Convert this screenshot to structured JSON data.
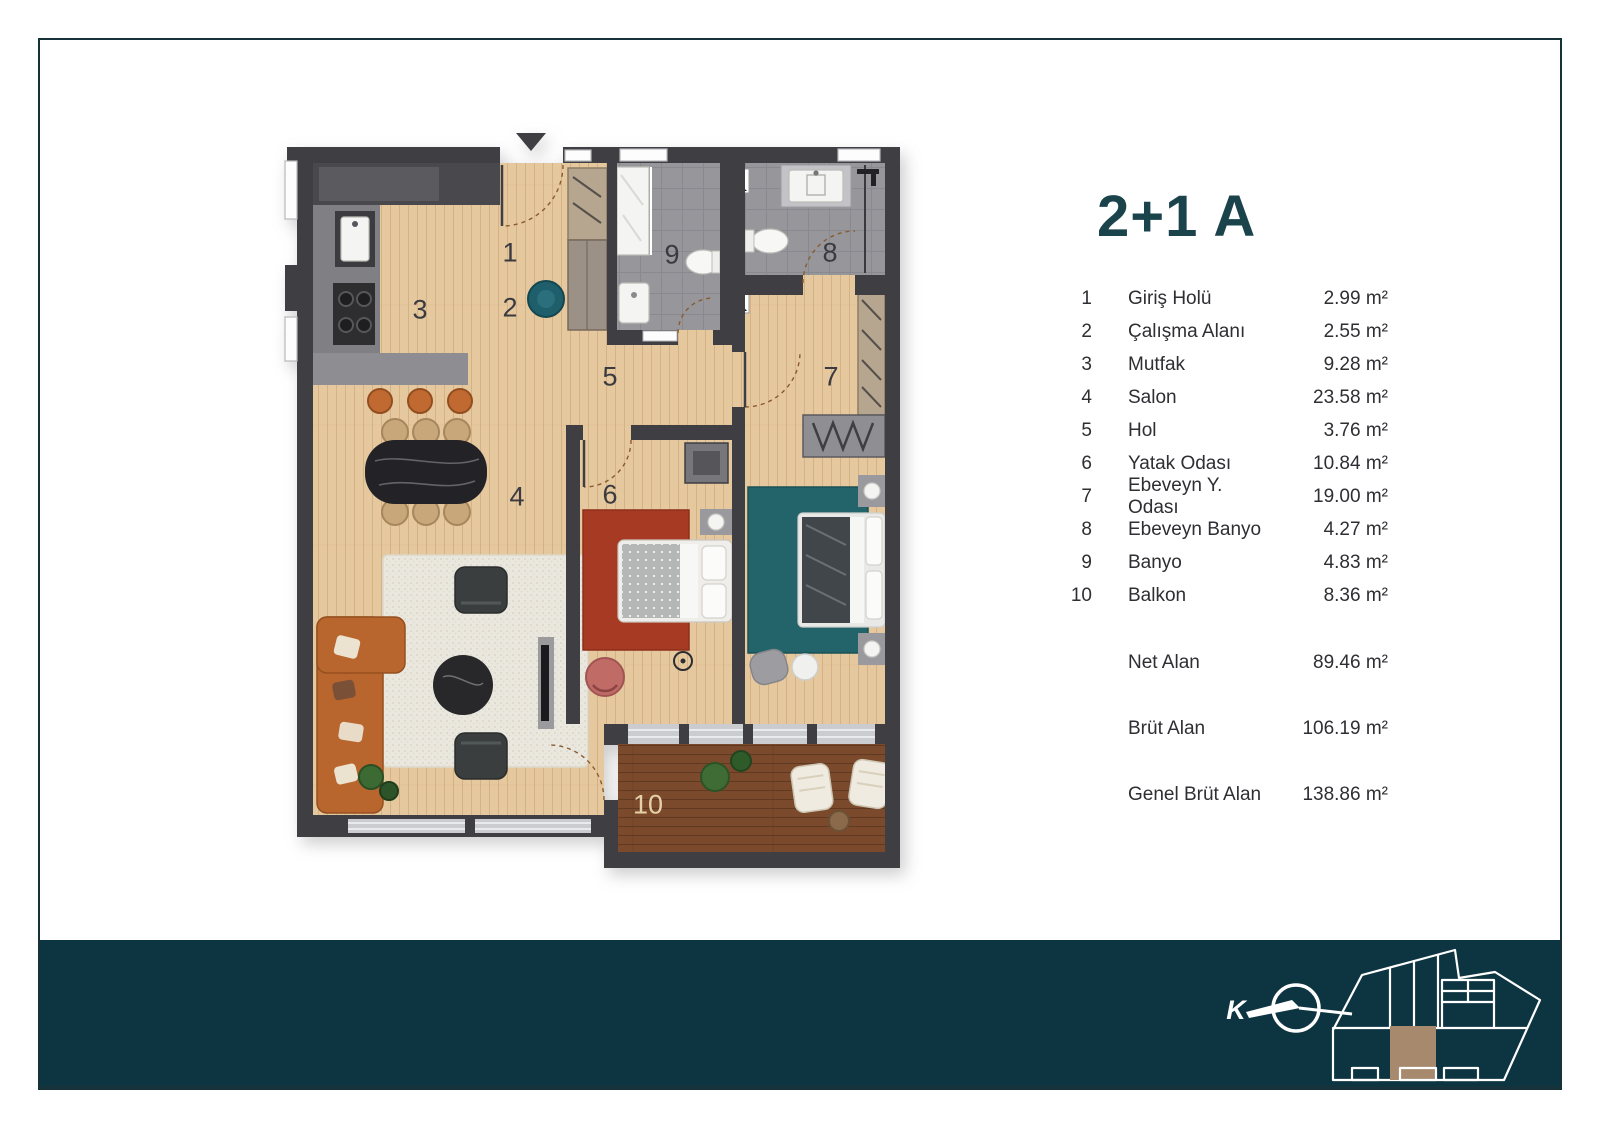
{
  "title": "2+1 A",
  "legend": {
    "rooms": [
      {
        "no": "1",
        "label": "Giriş Holü",
        "area": "2.99 m²"
      },
      {
        "no": "2",
        "label": "Çalışma Alanı",
        "area": "2.55 m²"
      },
      {
        "no": "3",
        "label": "Mutfak",
        "area": "9.28 m²"
      },
      {
        "no": "4",
        "label": "Salon",
        "area": "23.58 m²"
      },
      {
        "no": "5",
        "label": "Hol",
        "area": "3.76 m²"
      },
      {
        "no": "6",
        "label": "Yatak Odası",
        "area": "10.84 m²"
      },
      {
        "no": "7",
        "label": "Ebeveyn Y. Odası",
        "area": "19.00 m²"
      },
      {
        "no": "8",
        "label": "Ebeveyn Banyo",
        "area": "4.27 m²"
      },
      {
        "no": "9",
        "label": "Banyo",
        "area": "4.83 m²"
      },
      {
        "no": "10",
        "label": "Balkon",
        "area": "8.36 m²"
      }
    ],
    "totals": [
      {
        "label": "Net Alan",
        "value": "89.46 m²"
      },
      {
        "label": "Brüt Alan",
        "value": "106.19 m²"
      },
      {
        "label": "Genel Brüt Alan",
        "value": "138.86 m²"
      }
    ]
  },
  "footer": {
    "compass_letter": "K"
  },
  "icons": {
    "entrance_marker": "entrance-arrow-icon",
    "north": "north-compass-icon",
    "site_plan": "site-plan-icon"
  },
  "colors": {
    "teal": "#1b434c",
    "band": "#0d3541",
    "frame": "#16333c",
    "wall": "#3e3e43",
    "wood": "#e6c89e",
    "woodline": "#d5b286",
    "tile": "#97979b",
    "tileline": "#898a8f",
    "deck": "#7b4a2c",
    "deckline": "#5f3920",
    "rugred": "#a63a22",
    "rugteal": "#23646a",
    "rugwhite": "#eae7df",
    "sofa": "#b9652e",
    "stool": "#c06a32",
    "glazing": "#caccd0",
    "closet": "#b7a68f",
    "graybox": "#8e8e92",
    "number": "#3a3a40",
    "numberlight": "#e6d2a8",
    "highlight": "#a78a6e",
    "textdark": "#2e2e33",
    "doorarc": "#8a5a30",
    "chairpink": "#c16b66",
    "chairteal": "#1e5f6b",
    "plant": "#3f6b35",
    "white": "#ffffff"
  }
}
